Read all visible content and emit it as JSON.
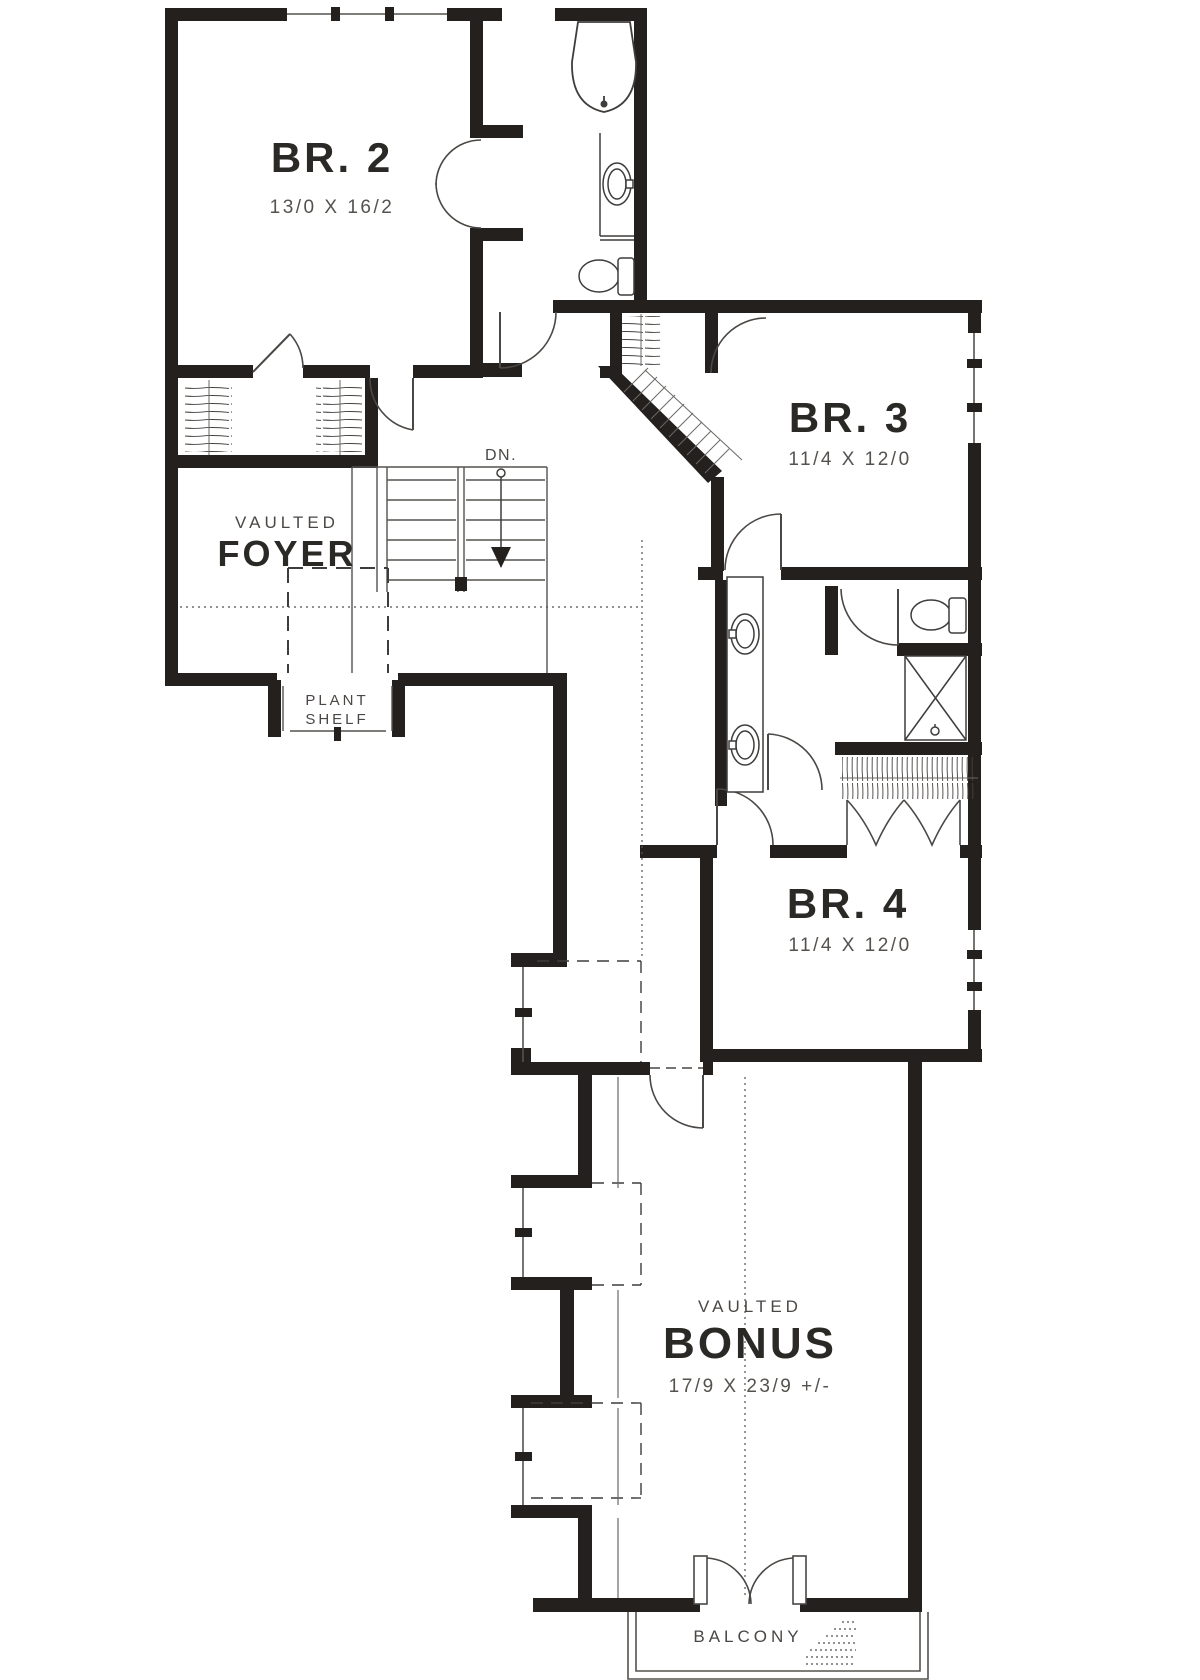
{
  "plan": {
    "type": "floor-plan",
    "colors": {
      "wall": "#23201d",
      "fixture_line": "#3f3d3b",
      "light_line": "#6b6864",
      "label_text": "#2b2926",
      "dim_text": "#55524e"
    },
    "rooms": {
      "br2": {
        "name": "BR. 2",
        "dims": "13/0 X 16/2"
      },
      "br3": {
        "name": "BR. 3",
        "dims": "11/4 X 12/0"
      },
      "br4": {
        "name": "BR. 4",
        "dims": "11/4 X 12/0"
      },
      "foyer": {
        "qualifier": "VAULTED",
        "name": "FOYER"
      },
      "bonus": {
        "qualifier": "VAULTED",
        "name": "BONUS",
        "dims": "17/9 X 23/9 +/-"
      },
      "plant_shelf": {
        "line1": "PLANT",
        "line2": "SHELF"
      },
      "balcony": {
        "name": "BALCONY"
      },
      "stairs": {
        "label": "DN."
      }
    }
  }
}
